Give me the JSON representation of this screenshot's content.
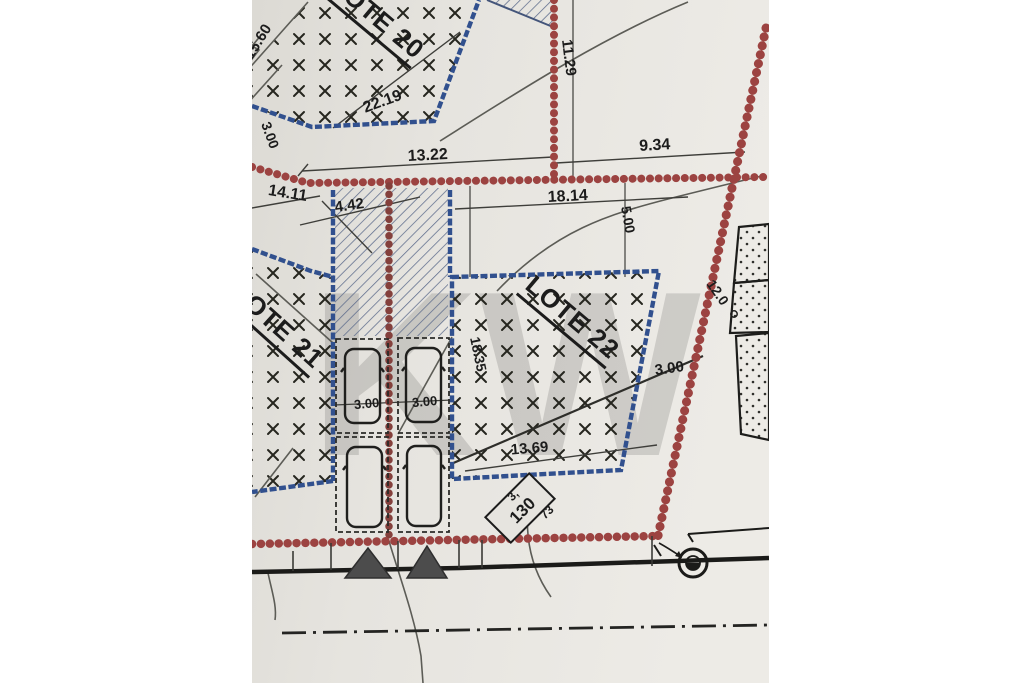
{
  "plan": {
    "title": "cadastral-site-plan",
    "lots": {
      "lote20": "LOTE 20",
      "lote21": "LOTE 21",
      "lote22": "LOTE 22"
    },
    "dims": {
      "d1560": "15.60",
      "d300left": "3.00",
      "d1411": "14.11",
      "d2219": "22.19",
      "d1322": "13.22",
      "d1129": "11.29",
      "d934": "9.34",
      "d1814": "18.14",
      "d500": "5.00",
      "d442": "4.42",
      "d1835": "18.35",
      "d300stallL": "3.00",
      "d300stallR": "3.00",
      "d1369": "13.69",
      "d300lot22": "3.00",
      "d120": "12.0"
    },
    "marker": {
      "prefix": "3,",
      "number": "130",
      "suffix": "73"
    },
    "watermark": "KW",
    "colors": {
      "lot_border_blue": "#31508e",
      "boundary_red": "#9c4341",
      "paper": "#e5e3de"
    }
  }
}
